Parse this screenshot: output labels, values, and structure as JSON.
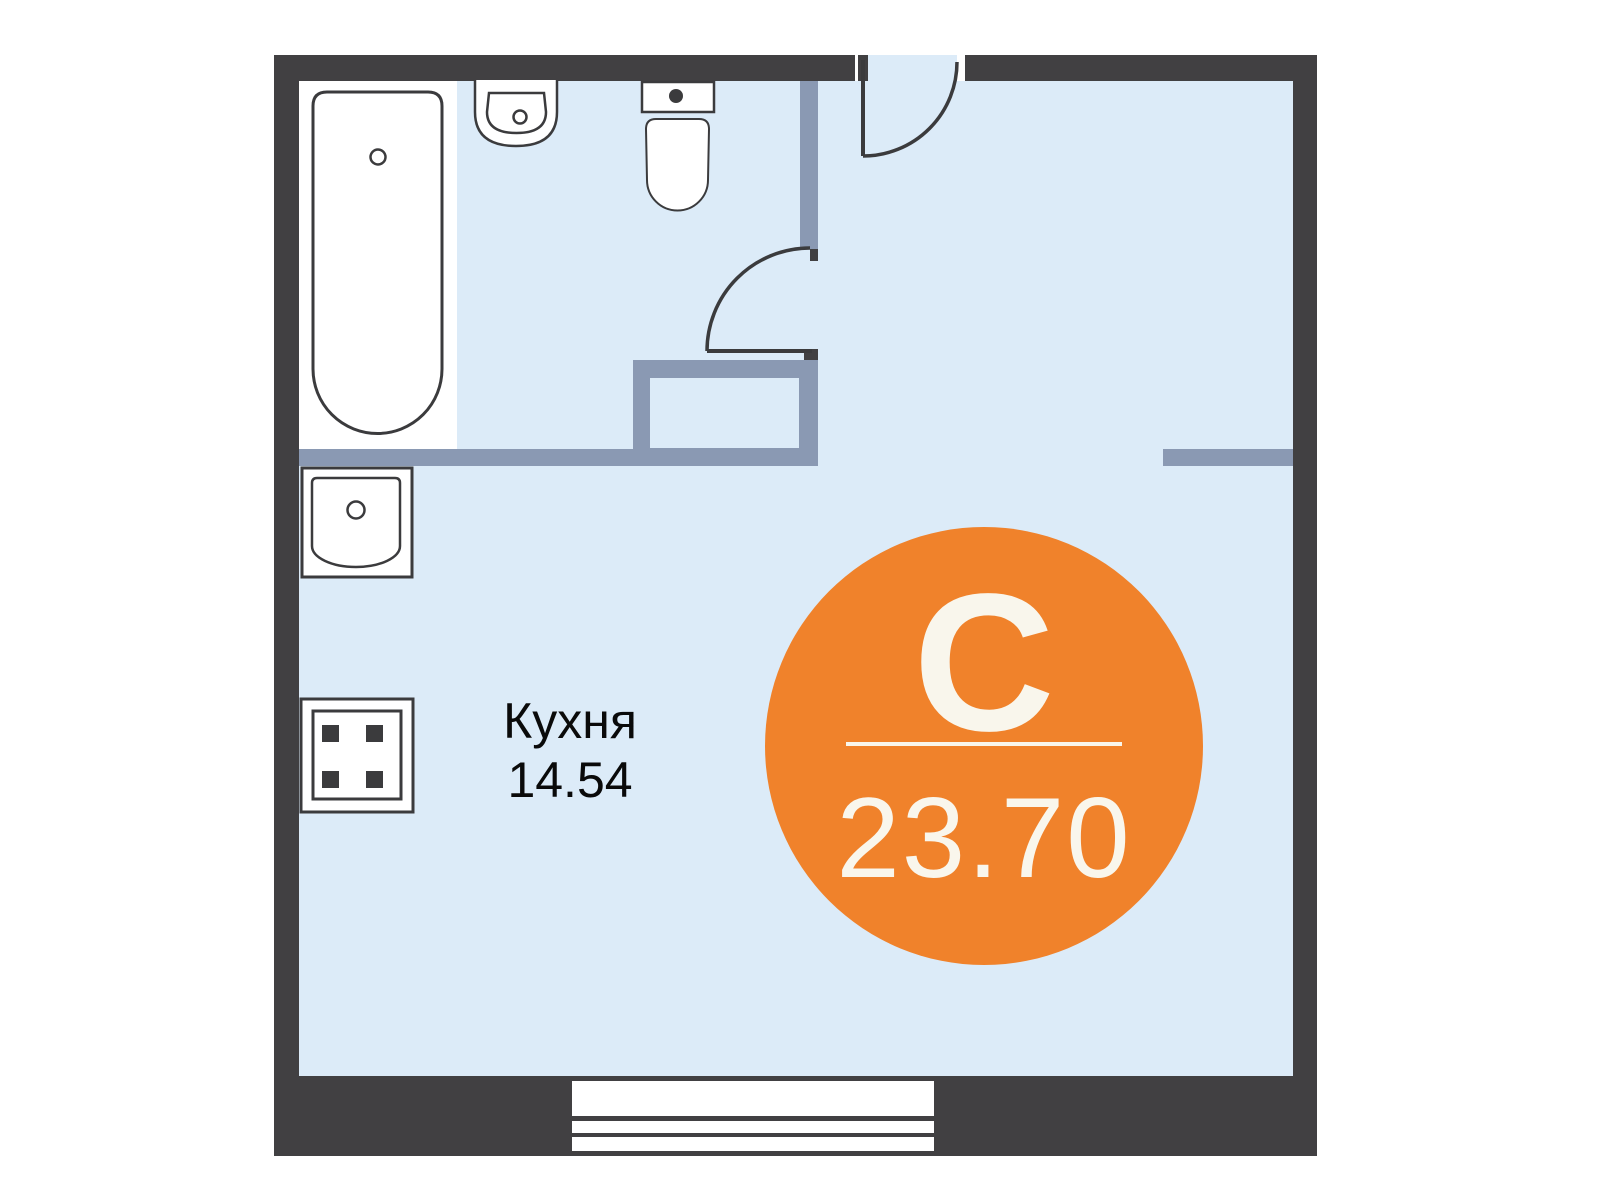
{
  "unit_badge": {
    "type_letter": "С",
    "total_area": "23.70"
  },
  "rooms": {
    "kitchen": {
      "name": "Кухня",
      "area": "14.54"
    }
  },
  "fixtures": [
    "bathtub",
    "washbasin",
    "toilet",
    "kitchen-sink",
    "stove-4-burners",
    "window",
    "entrance-door",
    "bathroom-door",
    "duct-shaft"
  ],
  "colors": {
    "wall_dark": "#414042",
    "wall_light": "#8a99b3",
    "floor": "#dcebf8",
    "outline": "#3b3b3d",
    "badge_bg": "#f0822b",
    "badge_text": "#f9f6ec",
    "label_text": "#0a0a0a"
  }
}
